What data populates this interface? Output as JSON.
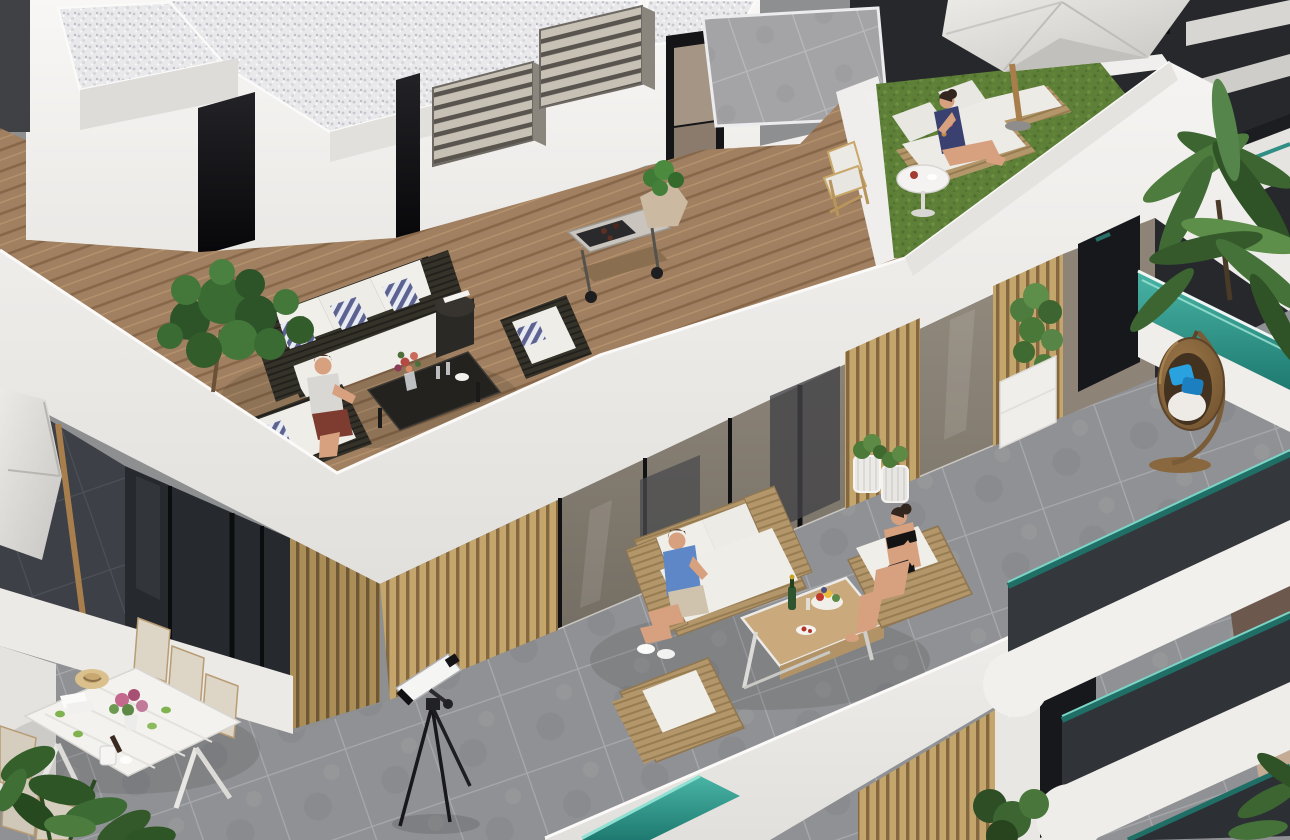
{
  "scene": {
    "type": "architectural-3d-rendering",
    "description": "Aerial dimetric rendering of a modern white apartment building corner with a rooftop terrace (wooden deck, dark rattan lounge set, BBQ cart, artificial grass with sun loungers and a woman under a parasol, white gravel roof volumes), a lower terrace with light rattan sofas, a man in a blue shirt and a woman in a black swimsuit around a wooden coffee table with champagne and fruit, a telescope, a white outdoor dining set with flowers and drinks, a hanging egg chair beside bamboo planters and teal glass balcony railings, palm trees and a dark neighboring building.",
    "time_of_day": "daylight",
    "people_count": 4
  },
  "palette": {
    "wall_white": "#f4f3f1",
    "wall_shade": "#e4e2df",
    "gravel": "#e9e9ec",
    "deck_wood": "#a08060",
    "grass_green": "#5d7f37",
    "roof_tile_gray": "#a4a4a6",
    "terrace_tile_gray": "#909194",
    "dark_tile": "#3d4046",
    "facade_dark": "#26292e",
    "glass_taupe": "#8d8478",
    "glass_dark": "#3f4043",
    "slat_wood": "#c4a66c",
    "louver_steel": "#c6c0b5",
    "rattan_dark": "#353229",
    "rattan_light": "#b3976b",
    "cushion_white": "#efede8",
    "pillow_stripe_blue": "#5c6390",
    "teal_glass": "#2f9488",
    "parasol_fabric": "#dedcd8",
    "wood_pole": "#a97e4d",
    "skin": "#d7a07f",
    "shirt_blue": "#5d87c6",
    "bikini_black": "#141414",
    "shorts_red": "#7e3b2f",
    "bottle_green": "#2f5430",
    "foliage_green": "#3a6b33",
    "palm_green": "#4e7c3e",
    "brown_wall": "#6d584e",
    "neighbor_dark": "#26282c",
    "table_white": "#f3f2ef",
    "chair_cream": "#ddd5c6",
    "oak_table": "#caa97c",
    "egg_chair_blue": "#29a2df"
  },
  "objects": [
    {
      "name": "gravel-roof",
      "label": "White gravel roof volumes"
    },
    {
      "name": "penthouse-walls",
      "label": "White penthouse walls"
    },
    {
      "name": "ac-louver-grilles",
      "label": "Two slatted AC louver boxes"
    },
    {
      "name": "roof-doors",
      "label": "Dark roof access doors"
    },
    {
      "name": "gray-roof-tiles",
      "label": "Gray tiled roof section"
    },
    {
      "name": "wooden-deck",
      "label": "Rooftop wooden deck"
    },
    {
      "name": "dark-rattan-sofa",
      "label": "Dark rattan sofa, white cushions, striped pillows"
    },
    {
      "name": "dark-rattan-armchair",
      "label": "Dark rattan armchair"
    },
    {
      "name": "dark-coffee-table",
      "label": "Dark rattan coffee table with flowers and glasses"
    },
    {
      "name": "drum-side-table",
      "label": "Drum side table with books"
    },
    {
      "name": "man-roof-terrace",
      "label": "Man seated on loveseat"
    },
    {
      "name": "bbq-cart",
      "label": "Stainless BBQ grill cart"
    },
    {
      "name": "stone-planter",
      "label": "Rock-shaped planter with shrub"
    },
    {
      "name": "fiddle-leaf-tree",
      "label": "Fiddle leaf fig tree"
    },
    {
      "name": "artificial-grass",
      "label": "Artificial grass area"
    },
    {
      "name": "sun-loungers",
      "label": "Rattan sun loungers with white pads"
    },
    {
      "name": "woman-on-lounger",
      "label": "Woman seated on sun lounger"
    },
    {
      "name": "wooden-deck-chair",
      "label": "Folding wooden deck chair"
    },
    {
      "name": "round-side-table",
      "label": "Round white side table with coffee"
    },
    {
      "name": "roof-parasol",
      "label": "Cantilever parasol over grass terrace"
    },
    {
      "name": "white-parapet",
      "label": "White roof parapet and fascia"
    },
    {
      "name": "glass-doors-band",
      "label": "Floor-to-ceiling sliding glass doors"
    },
    {
      "name": "wood-slat-piers",
      "label": "Vertical wood slat wall panels"
    },
    {
      "name": "lower-terrace",
      "label": "Gray tiled lower terrace"
    },
    {
      "name": "light-rattan-sofa",
      "label": "Light rattan sofa"
    },
    {
      "name": "man-blue-shirt",
      "label": "Man in blue T-shirt with drink"
    },
    {
      "name": "woman-black-swimsuit",
      "label": "Woman in black swimsuit on armchair"
    },
    {
      "name": "light-rattan-armchairs",
      "label": "Light rattan armchairs"
    },
    {
      "name": "oak-coffee-table",
      "label": "Oak coffee table with champagne and fruit"
    },
    {
      "name": "wire-planters",
      "label": "Wire basket planters"
    },
    {
      "name": "bamboo-planter",
      "label": "Bamboo in white box planter"
    },
    {
      "name": "telescope",
      "label": "Telescope on tripod"
    },
    {
      "name": "dining-set",
      "label": "White dining table with cream chairs, hat, flowers, cans"
    },
    {
      "name": "left-parasol",
      "label": "Parasol over shaded side terrace"
    },
    {
      "name": "hanging-egg-chair",
      "label": "Rattan hanging egg chair with blue pillows"
    },
    {
      "name": "teal-railings",
      "label": "Teal glass balcony railings"
    },
    {
      "name": "palm-trees",
      "label": "Palm trees"
    },
    {
      "name": "neighbor-building",
      "label": "Dark neighboring building with balconies"
    },
    {
      "name": "stacked-balconies",
      "label": "Stacked curved white balconies"
    },
    {
      "name": "bottom-left-plant",
      "label": "Leafy plant in foreground"
    }
  ]
}
